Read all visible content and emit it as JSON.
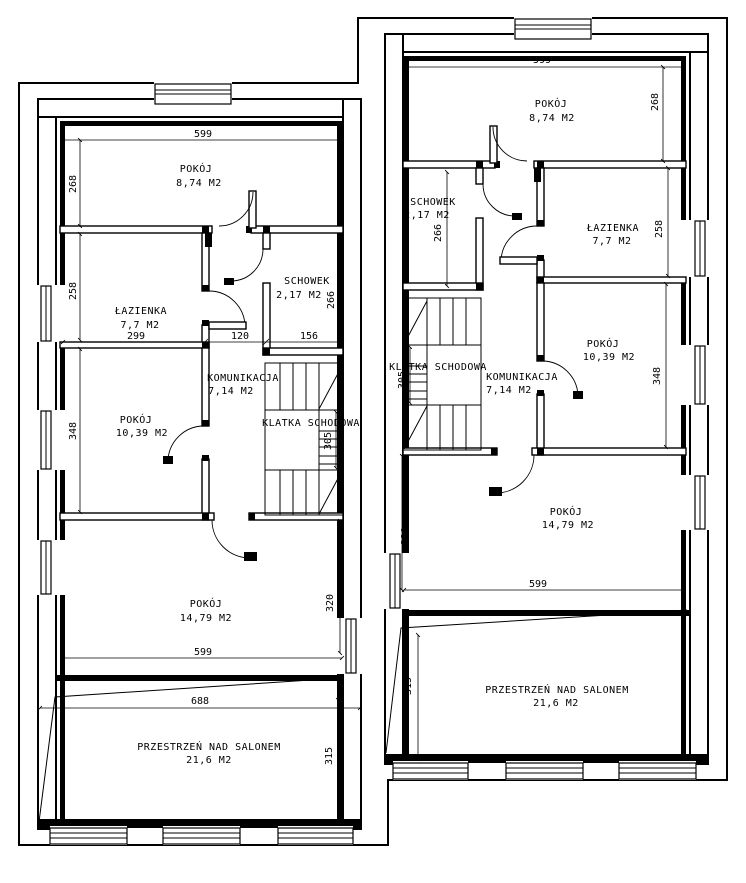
{
  "plan": {
    "left": {
      "rooms": {
        "pokoj_gorny": {
          "name": "POKÓJ",
          "area": "8,74 M2"
        },
        "lazienka": {
          "name": "ŁAZIENKA",
          "area": "7,7 M2"
        },
        "schowek": {
          "name": "SCHOWEK",
          "area": "2,17 M2"
        },
        "komunikacja": {
          "name": "KOMUNIKACJA",
          "area": "7,14 M2"
        },
        "pokoj_sredni": {
          "name": "POKÓJ",
          "area": "10,39 M2"
        },
        "klatka": {
          "name": "KLATKA SCHODOWA"
        },
        "pokoj_dolny": {
          "name": "POKÓJ",
          "area": "14,79 M2"
        },
        "przestrzen": {
          "name": "PRZESTRZEŃ NAD SALONEM",
          "area": "21,6 M2"
        }
      },
      "dims": {
        "d599_top": "599",
        "d268": "268",
        "d258": "258",
        "d299": "299",
        "d120": "120",
        "d156": "156",
        "d266": "266",
        "d348": "348",
        "d305": "305",
        "d320": "320",
        "d599_bottom": "599",
        "d688": "688",
        "d315": "315"
      }
    },
    "right": {
      "rooms": {
        "pokoj_gorny": {
          "name": "POKÓJ",
          "area": "8,74 M2"
        },
        "lazienka": {
          "name": "ŁAZIENKA",
          "area": "7,7 M2"
        },
        "schowek": {
          "name": "SCHOWEK",
          "area": "2,17 M2"
        },
        "komunikacja": {
          "name": "KOMUNIKACJA",
          "area": "7,14 M2"
        },
        "pokoj_sredni": {
          "name": "POKÓJ",
          "area": "10,39 M2"
        },
        "klatka": {
          "name": "KLATKA SCHODOWA"
        },
        "pokoj_dolny": {
          "name": "POKÓJ",
          "area": "14,79 M2"
        },
        "przestrzen": {
          "name": "PRZESTRZEŃ NAD SALONEM",
          "area": "21,6 M2"
        }
      },
      "dims": {
        "d599_top": "599",
        "d268": "268",
        "d266": "266",
        "d258": "258",
        "d348": "348",
        "d305": "305",
        "d320": "320",
        "d599_bottom": "599",
        "d315": "315"
      }
    }
  }
}
